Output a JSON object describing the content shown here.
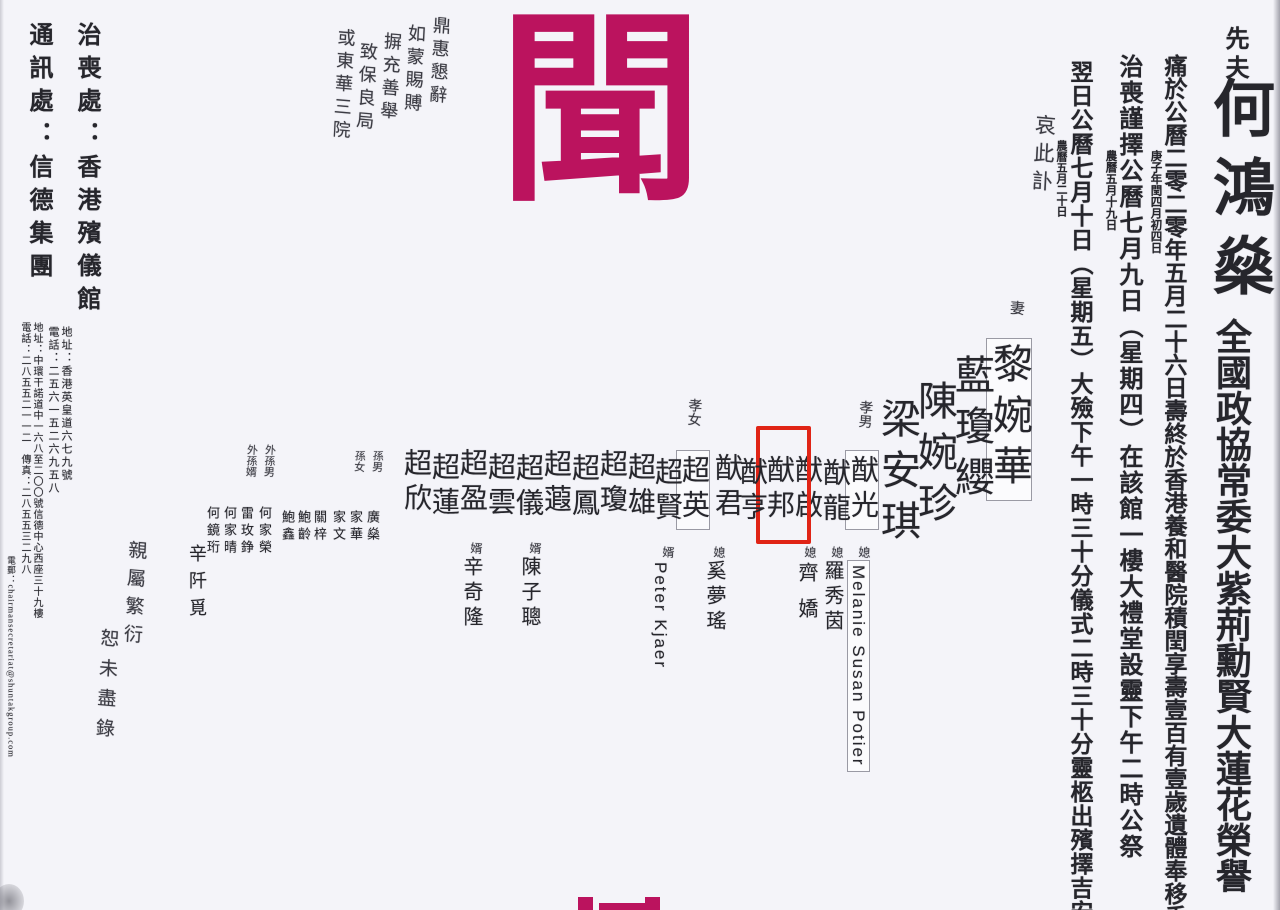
{
  "page": {
    "background": "#f4f4f9",
    "accent_color": "#bb135e",
    "highlight_color": "#e02416"
  },
  "masthead": {
    "big_char": "聞"
  },
  "deceased": {
    "prefix": "先夫",
    "name": "何鴻燊",
    "honors": "全國政協常委大紫荊勳賢大蓮花榮譽",
    "closing": "哀此訃"
  },
  "announcements": {
    "death": {
      "main": "痛於公曆二零二零年五月二十六日壽終於香港養和醫院積閏享壽壹百有壹歲遺體奉移香",
      "note": "庚子年閏四月初四日"
    },
    "vigil": {
      "main": "治喪謹擇公曆七月九日（星期四）在該館一樓大禮堂設靈下午二時公祭",
      "note": "農曆五月十九日"
    },
    "funeral": {
      "main": "翌日公曆七月十日（星期五）大殮下午一時三十分儀式二時三十分靈柩出殯擇吉安",
      "note": "農曆五月二十日"
    }
  },
  "family": {
    "wife_label": "妻",
    "wives": [
      {
        "name": "黎婉華"
      },
      {
        "name": "藍瓊纓"
      },
      {
        "name": "陳婉珍"
      },
      {
        "name": "梁安琪"
      }
    ],
    "sons_label": "孝男",
    "sons": [
      {
        "name": "猷光"
      },
      {
        "name": "猷龍"
      },
      {
        "name": "猷啟"
      },
      {
        "name": "猷邦"
      },
      {
        "name": "猷亨"
      },
      {
        "name": "猷君"
      }
    ],
    "daughters_label": "孝女",
    "daughters": [
      {
        "name": "超英"
      },
      {
        "name": "超賢"
      },
      {
        "name": "超雄"
      },
      {
        "name": "超瓊"
      },
      {
        "name": "超鳳"
      },
      {
        "name": "超蕸"
      },
      {
        "name": "超儀"
      },
      {
        "name": "超雲"
      },
      {
        "name": "超盈"
      },
      {
        "name": "超蓮"
      },
      {
        "name": "超欣"
      }
    ],
    "dil_label": "媳",
    "daughters_in_law": [
      {
        "name": "Melanie Susan Potier"
      },
      {
        "name": "羅秀茵"
      },
      {
        "name": "齊嬌"
      },
      {
        "name": "奚夢瑤"
      }
    ],
    "sil_label": "婿",
    "sons_in_law": [
      {
        "name": "Peter Kjaer"
      },
      {
        "name": "陳子聰"
      },
      {
        "name": "辛奇隆"
      }
    ],
    "grandson_label": "孫男",
    "grandsons": [
      {
        "name": "廣燊"
      }
    ],
    "granddaughter_label": "孫女",
    "granddaughters": [
      {
        "name": "家華"
      },
      {
        "name": "家文"
      }
    ],
    "mgs_label": "外孫男",
    "mgsil_label": "外孫婿",
    "relatives": [
      {
        "name": "關梓"
      },
      {
        "name": "鮑齡"
      },
      {
        "name": "鮑鑫"
      },
      {
        "name": "何家榮"
      },
      {
        "name": "雷玫錚"
      },
      {
        "name": "何家晴"
      },
      {
        "name": "何鏡珩"
      },
      {
        "name": "辛阡覓"
      }
    ],
    "note_line1": "親屬繁衍",
    "note_line2": "恕未盡錄"
  },
  "condolence": {
    "line1": "鼎惠懇辭",
    "line2": "如蒙賜賻",
    "line3": "摒充善舉",
    "line4": "致保良局",
    "line5": "或東華三院"
  },
  "contacts": {
    "funeral_parlour": "治喪處：香港殯儀館",
    "funeral_parlour_address": "地址：香港英皇道六七九號",
    "funeral_parlour_phone": "電話：二五六一五二六九五八",
    "correspondence": "通訊處：信德集團",
    "correspondence_address": "地址：中環干諾道中一六八至二〇〇號信德中心西座三十九樓",
    "correspondence_phone": "電話：二八五五二一一二　傳真：二八五五三二九八",
    "correspondence_email": "電郵：chairmansecretariat@shuntakgroup.com"
  }
}
